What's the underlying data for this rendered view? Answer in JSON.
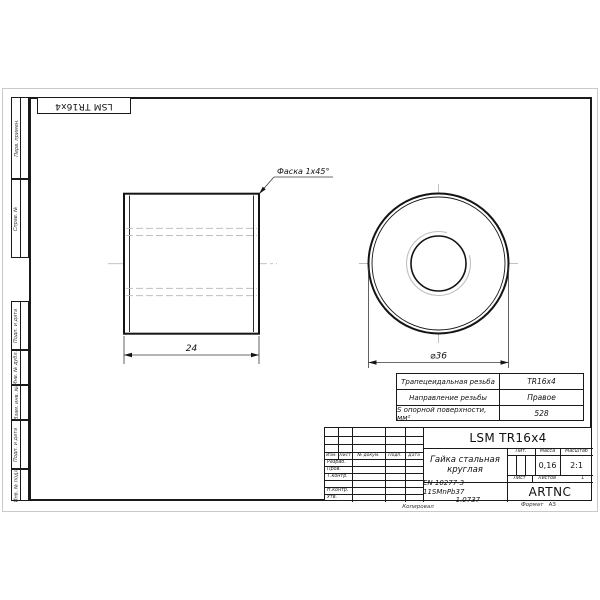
{
  "stamp": {
    "designation": "LSM TR16x4"
  },
  "left_strip": [
    {
      "label": "Перв. примен."
    },
    {
      "label": "Справ. №"
    },
    {
      "label": "Подп. и дата"
    },
    {
      "label": "Инв. № дубл."
    },
    {
      "label": "Взам. инв. №"
    },
    {
      "label": "Подп. и дата"
    },
    {
      "label": "Инв. № подл."
    }
  ],
  "views": {
    "chamfer_note": "Фаска 1x45°",
    "length_dim": "24",
    "diameter_dim": "⌀36"
  },
  "params_table": {
    "rows": [
      {
        "label": "Трапецеидальная резьба",
        "value": "TR16x4"
      },
      {
        "label": "Направление резьбы",
        "value": "Правое"
      },
      {
        "label": "S опорной поверхности, мм²",
        "value": "528"
      }
    ]
  },
  "title_block": {
    "designation": "LSM TR16x4",
    "part_name": "Гайка стальная круглая",
    "material_line1": "EN 10277-3 11SMnPb37",
    "material_line2": "– 1.0737",
    "company": "ARTNC",
    "columns": {
      "izm": "Изм.",
      "list": "Лист",
      "doc": "№ докум.",
      "podp": "Подп.",
      "data": "Дата"
    },
    "rows": {
      "razrab": "Разраб.",
      "prov": "Пров.",
      "tkontr": "Т.контр.",
      "nkontr": "Н.контр.",
      "utv": "Утв."
    },
    "lit_label": "Лит.",
    "mass_label": "Масса",
    "scale_label": "Масштаб",
    "mass_value": "0,16",
    "scale_value": "2:1",
    "sheet_label": "Лист",
    "sheets_label": "Листов",
    "sheets_value": "1"
  },
  "footer": {
    "copied": "Копировал",
    "format_label": "Формат",
    "format_value": "A3"
  }
}
